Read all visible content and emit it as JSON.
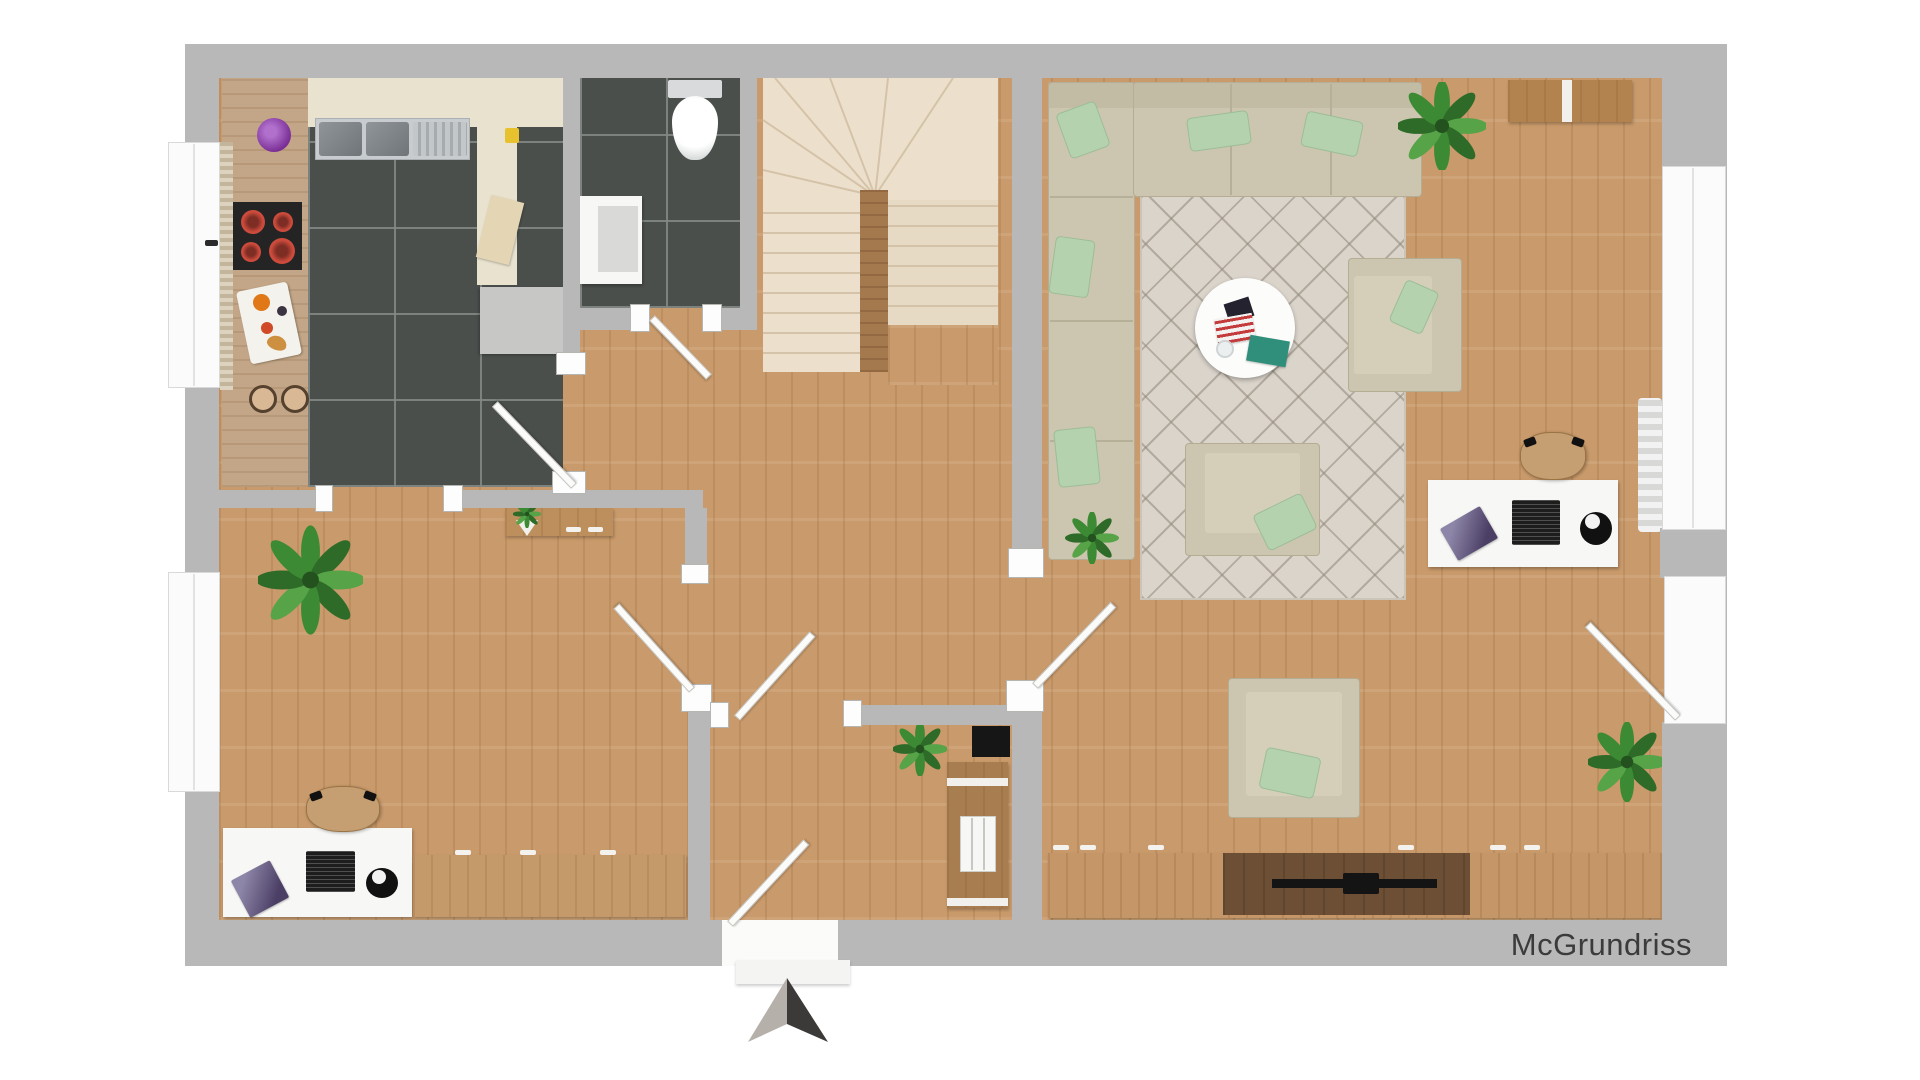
{
  "watermark": {
    "text": "McGrundriss"
  },
  "plan": {
    "type": "floor-plan-render",
    "view": "top-down",
    "rooms": [
      {
        "id": "kitchen",
        "floor": "dark-tile",
        "items": [
          "double-sink",
          "drainer",
          "cooktop-4-burners",
          "cream-counter",
          "wood-counter",
          "cutting-boards",
          "two-stools",
          "purple-plant",
          "gray-cabinet",
          "window",
          "door"
        ]
      },
      {
        "id": "bathroom",
        "floor": "dark-tile",
        "items": [
          "toilet",
          "vanity-cabinet",
          "door"
        ]
      },
      {
        "id": "staircase",
        "floor": "stairs",
        "items": [
          "winder-steps",
          "straight-treads",
          "center-post"
        ]
      },
      {
        "id": "hallway",
        "floor": "wood",
        "items": [
          "console-table",
          "mini-plant"
        ]
      },
      {
        "id": "office",
        "floor": "wood",
        "items": [
          "desk",
          "laptop",
          "office-chair",
          "desk-lamp",
          "magazine",
          "sideboard",
          "palm-plant",
          "window",
          "door"
        ]
      },
      {
        "id": "vestibule",
        "floor": "wood",
        "items": [
          "wardrobe",
          "shelf",
          "doormat",
          "plant",
          "entrance-door",
          "outside-step"
        ]
      },
      {
        "id": "living-room",
        "floor": "wood",
        "items": [
          "corner-sofa",
          "five-mint-pillows",
          "lattice-rug",
          "round-coffee-table",
          "magazines",
          "loveseat",
          "armchair-on-rug",
          "armchair-below-rug",
          "desk",
          "laptop",
          "office-chair",
          "desk-lamp",
          "tv-lowboard",
          "soundbar",
          "top-sideboard",
          "palm-plant",
          "door-plant",
          "corner-plant",
          "window",
          "terrace-door"
        ]
      }
    ],
    "icons": [
      "north-arrow-icon",
      "window-handle-icon"
    ],
    "palette": {
      "wall": "#b8b8b8",
      "wood_floor": "#c99a6b",
      "dark_tile": "#4b4f4c",
      "stair_cream": "#ece0cd",
      "stair_post": "#a5794e",
      "sofa_beige": "#ccc6b0",
      "pillow_mint": "#b5d2af",
      "rug": "#dad4cb",
      "counter_cream": "#e9e2cf",
      "counter_tan": "#c3a687",
      "furniture_wood": "#bd8f5d",
      "tv_dark_wood": "#6d4f35",
      "door_white": "#fbfbfa",
      "mat_black": "#161616",
      "burner_red": "#cc4b3c",
      "arrow_light": "#b5b0aa",
      "arrow_dark": "#3c3a38",
      "watermark_text": "#3b3b3b"
    }
  }
}
